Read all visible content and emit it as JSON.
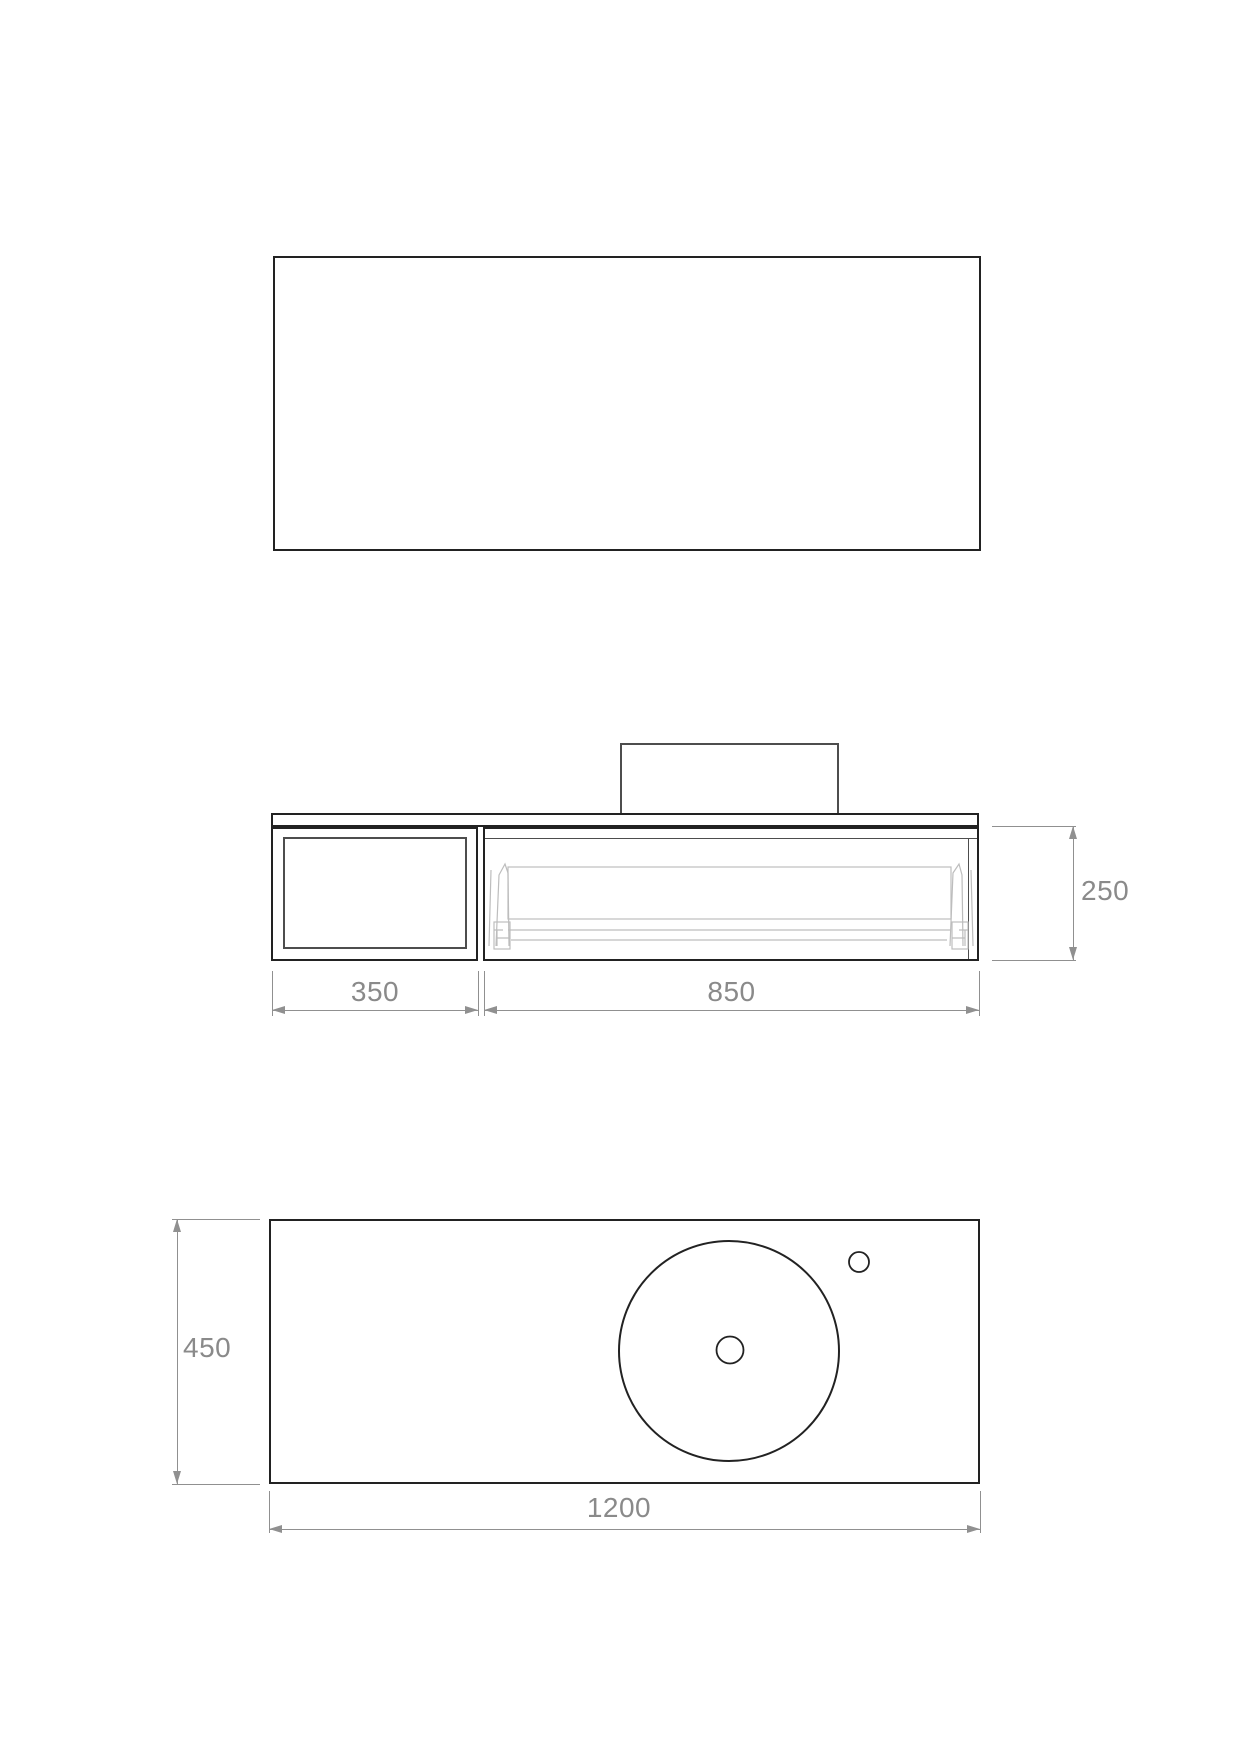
{
  "dimensions": {
    "left_compartment_width": "350",
    "drawer_unit_width": "850",
    "cabinet_height": "250",
    "countertop_depth": "450",
    "countertop_width": "1200"
  },
  "colors": {
    "outline": "#222222",
    "outline_soft": "#4d4d4d",
    "hidden": "#bdbdbd",
    "dim": "#909090",
    "dim_text": "#8a8a8a",
    "bg": "#ffffff"
  }
}
